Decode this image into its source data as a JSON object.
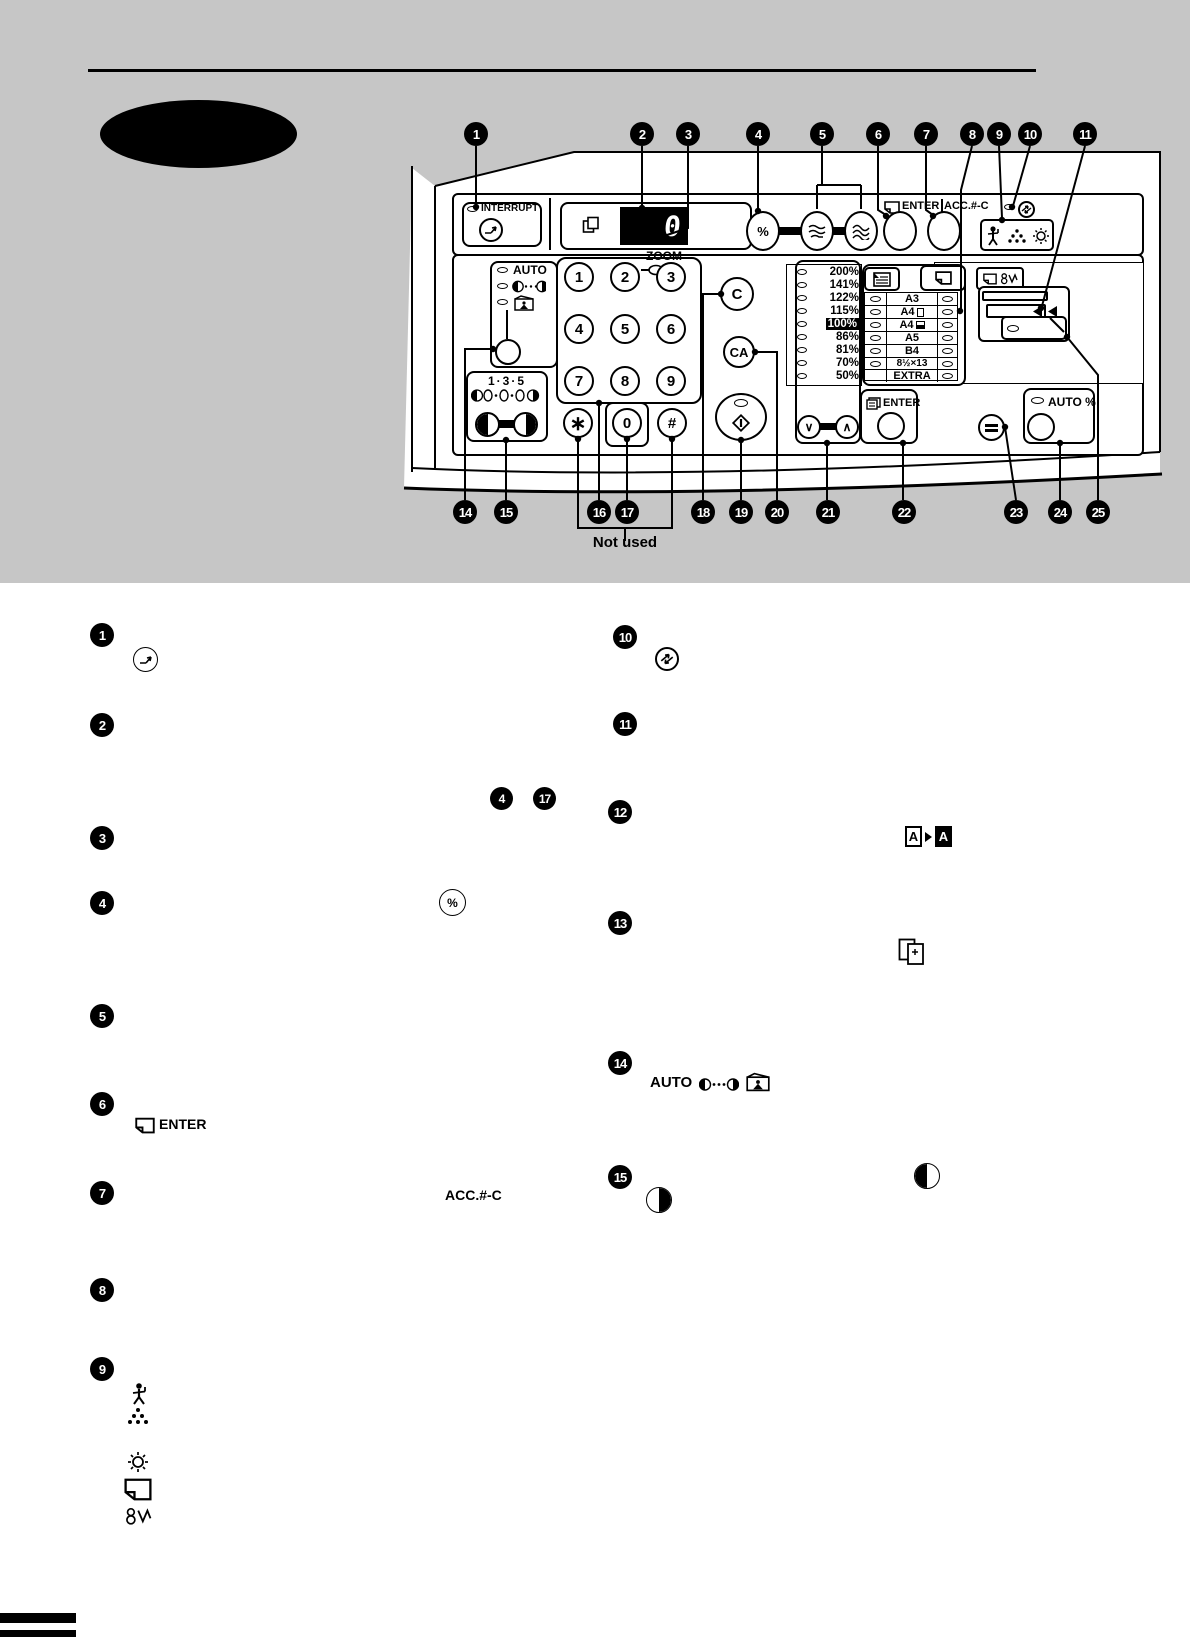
{
  "colors": {
    "band": "#c6c6c6",
    "ink": "#000000"
  },
  "callouts": {
    "c1": "1",
    "c2": "2",
    "c3": "3",
    "c4": "4",
    "c5": "5",
    "c6": "6",
    "c7": "7",
    "c8": "8",
    "c9": "9",
    "c10": "10",
    "c11": "11",
    "c12": "12",
    "c13": "13",
    "c14": "14",
    "c15": "15",
    "c16": "16",
    "c17": "17",
    "c18": "18",
    "c19": "19",
    "c20": "20",
    "c21": "21",
    "c22": "22",
    "c23": "23",
    "c24": "24",
    "c25": "25"
  },
  "panel": {
    "interrupt_label": "INTERRUPT",
    "zoom_label": "ZOOM",
    "display_value": "0",
    "percent_label": "%",
    "enter_top_label": "ENTER",
    "acc_label": "ACC.#-C",
    "auto_label": "AUTO",
    "scale_label": "1·3·5",
    "down_glyph": "∨",
    "up_glyph": "∧",
    "ratios": [
      "200%",
      "141%",
      "122%",
      "115%",
      "100%",
      "86%",
      "81%",
      "70%",
      "50%"
    ],
    "papers": [
      "A3",
      "A4",
      "A4",
      "A5",
      "B4",
      "8½×13",
      "EXTRA"
    ],
    "keys": [
      "1",
      "2",
      "3",
      "4",
      "5",
      "6",
      "7",
      "8",
      "9"
    ],
    "star_key": "∗",
    "zero_key": "0",
    "hash_key": "#",
    "clear_key": "C",
    "clear_all_key": "CA",
    "enter_bottom_label": "ENTER",
    "auto_percent_label": "AUTO %"
  },
  "diagram": {
    "not_used": "Not used"
  },
  "legend": {
    "enter_label": "ENTER",
    "acc_label": "ACC.#-C",
    "auto_label": "AUTO",
    "a_letter": "A"
  }
}
